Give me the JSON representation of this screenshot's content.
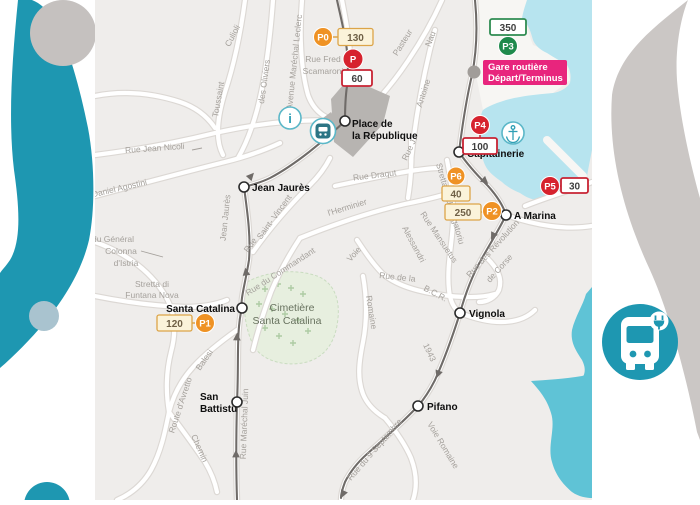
{
  "colors": {
    "teal": "#1e97b1",
    "gray_circle": "#c5c1bf",
    "ring_gray": "#cbc7c5",
    "dot_blue": "#a9c3cf",
    "land": "#efedeb",
    "water_harbor": "#b7e4ef",
    "water_sea": "#5fc3d6",
    "cemetery": "#e7efdf",
    "route": "#6f6b68",
    "orange": "#ef9224",
    "red": "#d6232e",
    "green": "#1f8a4c",
    "magenta": "#e8257d"
  },
  "parking": {
    "p0": {
      "label": "P0",
      "value": "130"
    },
    "p_centre": {
      "label": "P",
      "value": "60"
    },
    "p3": {
      "label": "P3",
      "value": "350"
    },
    "p4": {
      "label": "P4",
      "value": "100"
    },
    "p6": {
      "label": "P6",
      "value": "40"
    },
    "p2": {
      "label": "P2",
      "value": "250"
    },
    "p5": {
      "label": "P5",
      "value": "30"
    },
    "p1": {
      "label": "P1",
      "value": "120"
    }
  },
  "stops": {
    "gare_line1": "Gare routière",
    "gare_line2": "Départ/Terminus",
    "place_line1": "Place de",
    "place_line2": "la République",
    "jean_jaures": "Jean Jaurès",
    "capitainerie": "Capitainerie",
    "a_marina": "A Marina",
    "santa_catalina": "Santa Catalina",
    "vignola": "Vignola",
    "san_battistu_line1": "San",
    "san_battistu_line2": "Battistu",
    "pifano": "Pifano"
  },
  "areas": {
    "cemetery_line1": "Cimetière",
    "cemetery_line2": "Santa Catalina"
  },
  "streets": {
    "leclerc": "Avenue Maréchal Leclerc",
    "culioli": "Culioli",
    "toussaint": "Toussaint",
    "des_oliviers": "des Oliviers",
    "rue_fred_line1": "Rue Fred",
    "rue_fred_line2": "Scamaroni",
    "pasteur": "Pasteur",
    "nau": "Nau",
    "antoine": "Antoine",
    "rue_j": "Rue J.",
    "rue_draqut": "Rue Draqut",
    "jean_nicoli": "Rue Jean Nicoli",
    "agostini": "Daniel Agostini",
    "jean_jaures": "Jean Jaurès",
    "rue_sv": "Rue",
    "saint_vincent": "Saint- Vincent",
    "lherminier": "l'Herminier",
    "commandant": "Rue du Commandant",
    "colonna_line1": "du Général",
    "colonna_line2": "Colonna",
    "colonna_line3": "d'Istria",
    "funtana_line1": "Stretta di",
    "funtana_line2": "Funtana Nova",
    "balesi": "Balesi",
    "avretto": "Route d'Avretto",
    "chemin": "Chemin",
    "marechal_juin": "Rue Maréchal Juin",
    "voie": "Voie",
    "rue_de_la": "Rue de la",
    "bcr": "B.C.R.",
    "romaine": "Romaine",
    "mansuetus": "Rue Mansuetus",
    "alessandri": "Alessandri",
    "purgatoriu": "Stretta di U Purgatoriu",
    "revolution_line1": "Rue des Révolution",
    "revolution_line2": "de Corse",
    "y1943": "1943",
    "septembre": "Rue du 9 Septembre",
    "voie_romaine": "Voie Romaine"
  },
  "icons": {
    "info": "i"
  }
}
